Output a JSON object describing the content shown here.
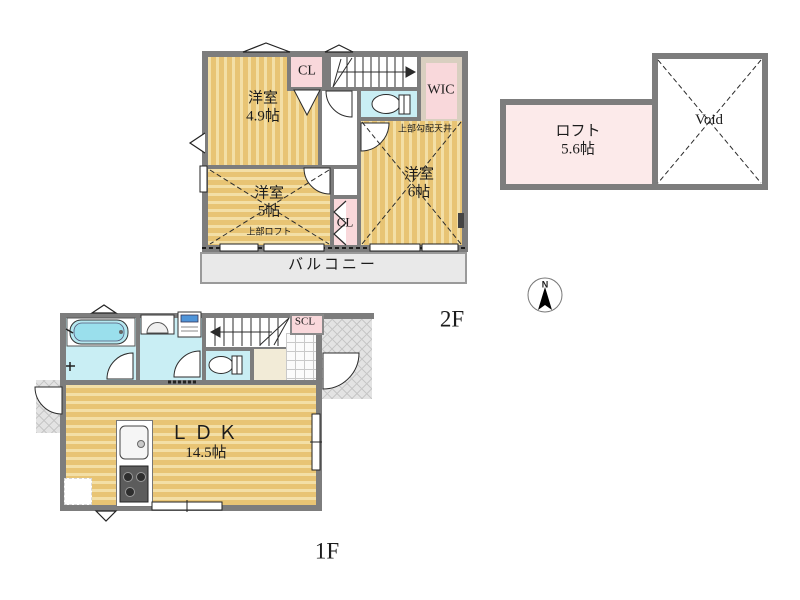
{
  "floor2": {
    "label": "2F",
    "room49": {
      "name": "洋室",
      "size": "4.9帖"
    },
    "cl_top": {
      "label": "CL"
    },
    "wic": {
      "label": "WIC"
    },
    "room6": {
      "name": "洋室",
      "size": "6帖",
      "note": "上部勾配天井"
    },
    "room5": {
      "name": "洋室",
      "size": "5帖",
      "note": "上部ロフト"
    },
    "cl_bottom": {
      "label": "CL"
    },
    "balcony": {
      "label": "バルコニー"
    },
    "loft": {
      "name": "ロフト",
      "size": "5.6帖"
    },
    "void": {
      "label": "Void"
    }
  },
  "floor1": {
    "label": "1F",
    "ldk": {
      "name": "ＬＤＫ",
      "size": "14.5帖"
    },
    "scl": {
      "label": "SCL"
    }
  },
  "compass": {
    "north_label": "N"
  },
  "icons": [
    "compass-icon",
    "toilet-icon",
    "bathtub-icon",
    "washbasin-icon",
    "washing-machine-icon",
    "kitchen-sink-icon",
    "stove-icon",
    "stairs-up-icon",
    "stairs-down-icon",
    "door-swing-icon",
    "folding-door-icon",
    "window-icon",
    "awning-window-icon"
  ],
  "colors": {
    "floor_yellow": "#e8c474",
    "floor_stripe": "#f3dfa6",
    "accent_pink": "#f9d8db",
    "loft_pink": "#fceaea",
    "water_cyan": "#c9eef4",
    "wall_gray": "#7d7d7d",
    "balcony_gray": "#e9e9e9",
    "hall_beige": "#f2ebd7",
    "wic_beige": "#d9cfc0"
  }
}
